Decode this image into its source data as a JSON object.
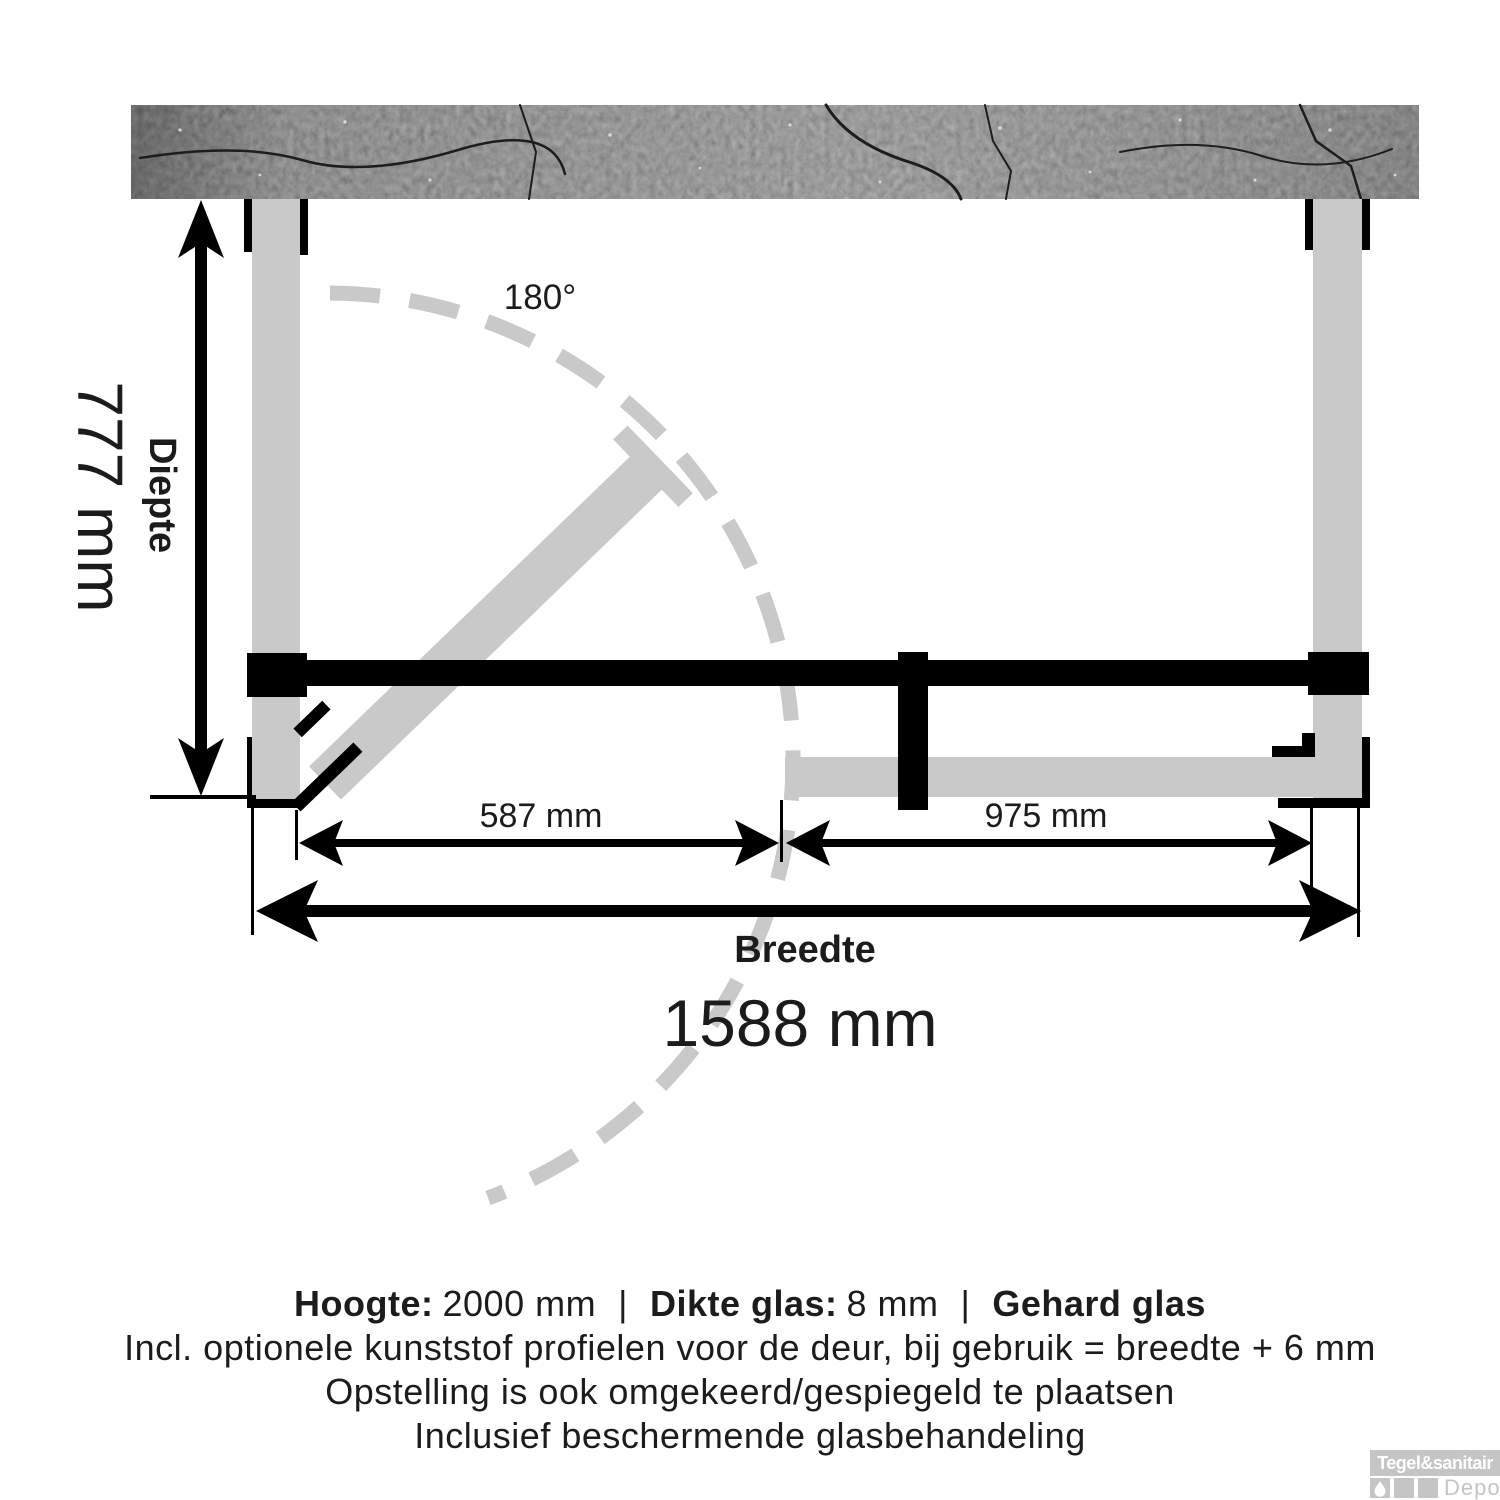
{
  "figure": {
    "angle_label": "180°",
    "depth_label": "Diepte",
    "depth_value": "777 mm",
    "width_label": "Breedte",
    "width_value": "1588 mm",
    "door_width_value": "587 mm",
    "panel_width_value": "975 mm"
  },
  "caption": {
    "height_label": "Hoogte:",
    "height_value": "2000 mm",
    "separator": "|",
    "glass_thickness_label": "Dikte glas:",
    "glass_thickness_value": "8 mm",
    "glass_type": "Gehard glas",
    "line2": "Incl. optionele kunststof profielen voor de deur, bij gebruik = breedte + 6 mm",
    "line3": "Opstelling is ook omgekeerd/gespiegeld te plaatsen",
    "line4": "Inclusief beschermende glasbehandeling"
  },
  "logo": {
    "brand": "Tegel&sanitair",
    "sub_brand": "Depot"
  },
  "colors": {
    "glass_gray": "#c9c9c9",
    "line_black": "#000000",
    "wall_base": "#3d3d3d",
    "logo_gray": "#c5c5c5"
  }
}
